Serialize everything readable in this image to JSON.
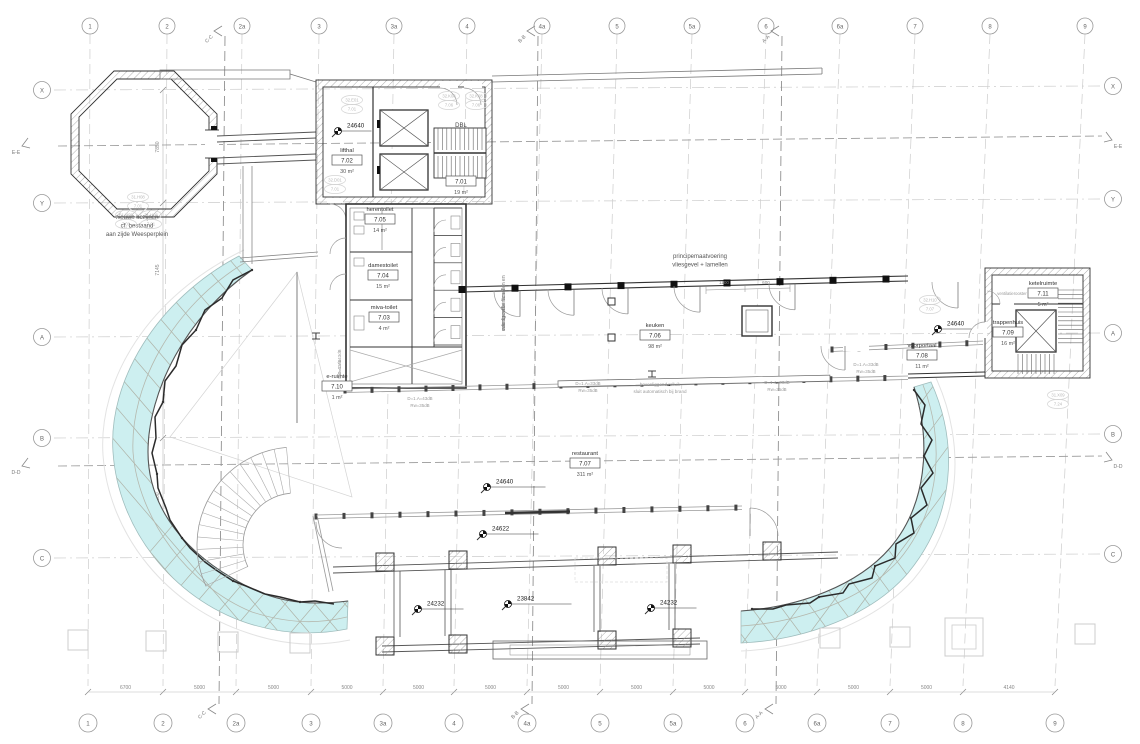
{
  "labels": {
    "dbl": "DBL",
    "ventilation": "ventilatierooster"
  },
  "grid": {
    "cols": [
      "1",
      "2",
      "2a",
      "3",
      "3a",
      "4",
      "4a",
      "5",
      "5a",
      "6",
      "6a",
      "7",
      "8",
      "9"
    ],
    "col_x": [
      90,
      167,
      242,
      319,
      394,
      467,
      542,
      617,
      692,
      766,
      840,
      915,
      990,
      1085
    ],
    "rows": [
      "X",
      "Y",
      "A",
      "B",
      "C"
    ],
    "row_y": [
      90,
      203,
      337,
      438,
      558
    ],
    "dims_bottom": [
      "6700",
      "5000",
      "5000",
      "5000",
      "5000",
      "5000",
      "5000",
      "5000",
      "5000",
      "5000",
      "5000",
      "5000",
      "4140"
    ],
    "dims_left": [
      {
        "v": "7850",
        "y": 147
      },
      {
        "v": "7145",
        "y": 270
      },
      {
        "v": "9115",
        "y": 388
      },
      {
        "v": "8300",
        "y": 498
      }
    ]
  },
  "sections": {
    "vertical": [
      {
        "label": "C-C",
        "x": 225
      },
      {
        "label": "B-B",
        "x": 538
      },
      {
        "label": "A-A",
        "x": 782
      }
    ],
    "horizontal": [
      {
        "label": "E-E",
        "y": 142
      },
      {
        "label": "D-D",
        "y": 462
      }
    ]
  },
  "rooms": [
    {
      "name": "",
      "code": "7.01",
      "area": "19 m²",
      "x": 461,
      "y": 173
    },
    {
      "name": "lifthal",
      "code": "7.02",
      "area": "30 m²",
      "x": 347,
      "y": 152
    },
    {
      "name": "miva-toilet",
      "code": "7.03",
      "area": "4 m²",
      "x": 384,
      "y": 309
    },
    {
      "name": "damestoilet",
      "code": "7.04",
      "area": "15 m²",
      "x": 383,
      "y": 267
    },
    {
      "name": "herentoilet",
      "code": "7.05",
      "area": "14 m²",
      "x": 380,
      "y": 211
    },
    {
      "name": "keuken",
      "code": "7.06",
      "area": "98 m²",
      "x": 655,
      "y": 327
    },
    {
      "name": "restaurant",
      "code": "7.07",
      "area": "311 m²",
      "x": 585,
      "y": 455
    },
    {
      "name": "voorportaal",
      "code": "7.08",
      "area": "11 m²",
      "x": 922,
      "y": 347
    },
    {
      "name": "trappenhuis",
      "code": "7.09",
      "area": "16 m²",
      "x": 1008,
      "y": 324
    },
    {
      "name": "e-ruimte",
      "code": "7.10",
      "area": "1 m²",
      "x": 337,
      "y": 378
    },
    {
      "name": "ketelruimte",
      "code": "7.11",
      "area": "5 m²",
      "x": 1043,
      "y": 285
    }
  ],
  "markers": [
    {
      "label": "24640",
      "x": 338,
      "y": 131,
      "len": 30
    },
    {
      "label": "24640",
      "x": 938,
      "y": 329,
      "len": 30
    },
    {
      "label": "24640",
      "x": 487,
      "y": 487,
      "len": 55
    },
    {
      "label": "24622",
      "x": 483,
      "y": 534,
      "len": 52
    },
    {
      "label": "23842",
      "x": 508,
      "y": 604,
      "len": 60
    },
    {
      "label": "24232",
      "x": 418,
      "y": 609,
      "len": 42
    },
    {
      "label": "24232",
      "x": 651,
      "y": 608,
      "len": 42
    }
  ],
  "notes": [
    {
      "x": 137,
      "y": 219,
      "size": 6,
      "color": "#555",
      "rot": 0,
      "lines": [
        "nieuwe kozijnen",
        "cf. bestaand",
        "aan zijde Weesperplein"
      ]
    },
    {
      "x": 700,
      "y": 258,
      "size": 6,
      "color": "#555",
      "rot": 0,
      "lines": [
        "principemaatvoering",
        "vliesgevel + lamellen"
      ]
    },
    {
      "x": 660,
      "y": 386,
      "size": 4.6,
      "color": "#999",
      "rot": 0,
      "lines": [
        "bovenliggend rolluik",
        "sluit automatisch bij brand"
      ]
    },
    {
      "x": 505,
      "y": 302,
      "size": 5,
      "color": "#777",
      "rot": -90,
      "lines": [
        "vliesgevel + lamellen en",
        "eventueel verticaal",
        "over breedte"
      ]
    },
    {
      "x": 420,
      "y": 400,
      "size": 4.4,
      "color": "#999",
      "rot": 0,
      "lines": [
        "D=1.A=43dB",
        "Rw=35dB"
      ]
    },
    {
      "x": 588,
      "y": 385,
      "size": 4.4,
      "color": "#999",
      "rot": 0,
      "lines": [
        "D=1.A=33dB",
        "Rw=35dB"
      ]
    },
    {
      "x": 777,
      "y": 384,
      "size": 4.4,
      "color": "#999",
      "rot": 0,
      "lines": [
        "D=1.A=33dB",
        "Rw=35dB"
      ]
    },
    {
      "x": 866,
      "y": 366,
      "size": 4.4,
      "color": "#999",
      "rot": 0,
      "lines": [
        "D=1.A=33dB",
        "Rw=35dB"
      ]
    },
    {
      "x": 341,
      "y": 362,
      "size": 4.4,
      "color": "#999",
      "rot": -90,
      "lines": [
        "D=1.A=43dB",
        "Rw=43dB"
      ]
    },
    {
      "x": 724,
      "y": 284,
      "size": 4.6,
      "color": "#888",
      "rot": 0,
      "lines": [
        "1100"
      ]
    },
    {
      "x": 766,
      "y": 284,
      "size": 4.6,
      "color": "#888",
      "rot": 0,
      "lines": [
        "600"
      ]
    }
  ],
  "tags": [
    {
      "l1": "31.H08",
      "l2": "7.01",
      "x": 138,
      "y": 197
    },
    {
      "l1": "31.H08",
      "l2": "7.01",
      "x": 126,
      "y": 215
    },
    {
      "l1": "31.H08",
      "l2": "7.01",
      "x": 151,
      "y": 215
    },
    {
      "l1": "32.K08",
      "l2": "7.06",
      "x": 449,
      "y": 96
    },
    {
      "l1": "32.K08",
      "l2": "7.06",
      "x": 476,
      "y": 96
    },
    {
      "l1": "32.E01",
      "l2": "7.01",
      "x": 352,
      "y": 100
    },
    {
      "l1": "32.D01",
      "l2": "7.01",
      "x": 335,
      "y": 180
    },
    {
      "l1": "32.H10",
      "l2": "7.07",
      "x": 930,
      "y": 300
    },
    {
      "l1": "31.X09",
      "l2": "7.24",
      "x": 1058,
      "y": 395
    }
  ],
  "colors": {
    "glass": "#cdeff0",
    "wall": "#333333",
    "grid": "#cccccc",
    "faint": "#bbbbbb",
    "accent": "#111111"
  }
}
